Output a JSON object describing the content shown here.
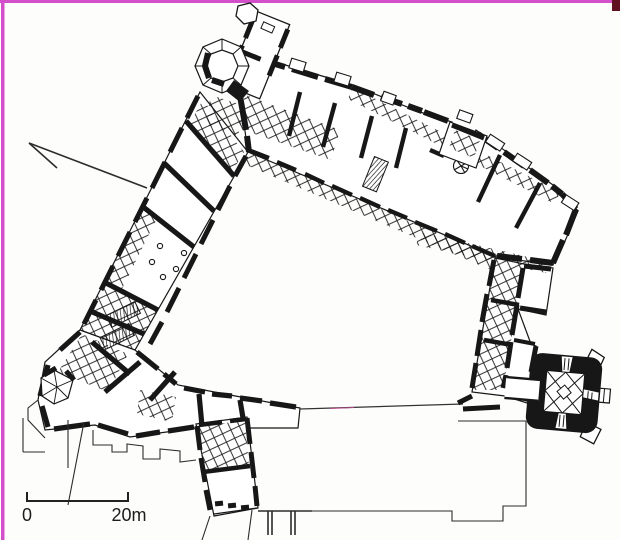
{
  "figure": {
    "type": "architectural-floor-plan",
    "ink_color": "#171717",
    "paper_color": "#fdfdfc",
    "scan_border_color": "#d44fca",
    "corner_mark_color": "#611020",
    "faint_line_color": "#b54a86"
  },
  "scale_bar": {
    "start_label": "0",
    "end_label": "20m"
  }
}
